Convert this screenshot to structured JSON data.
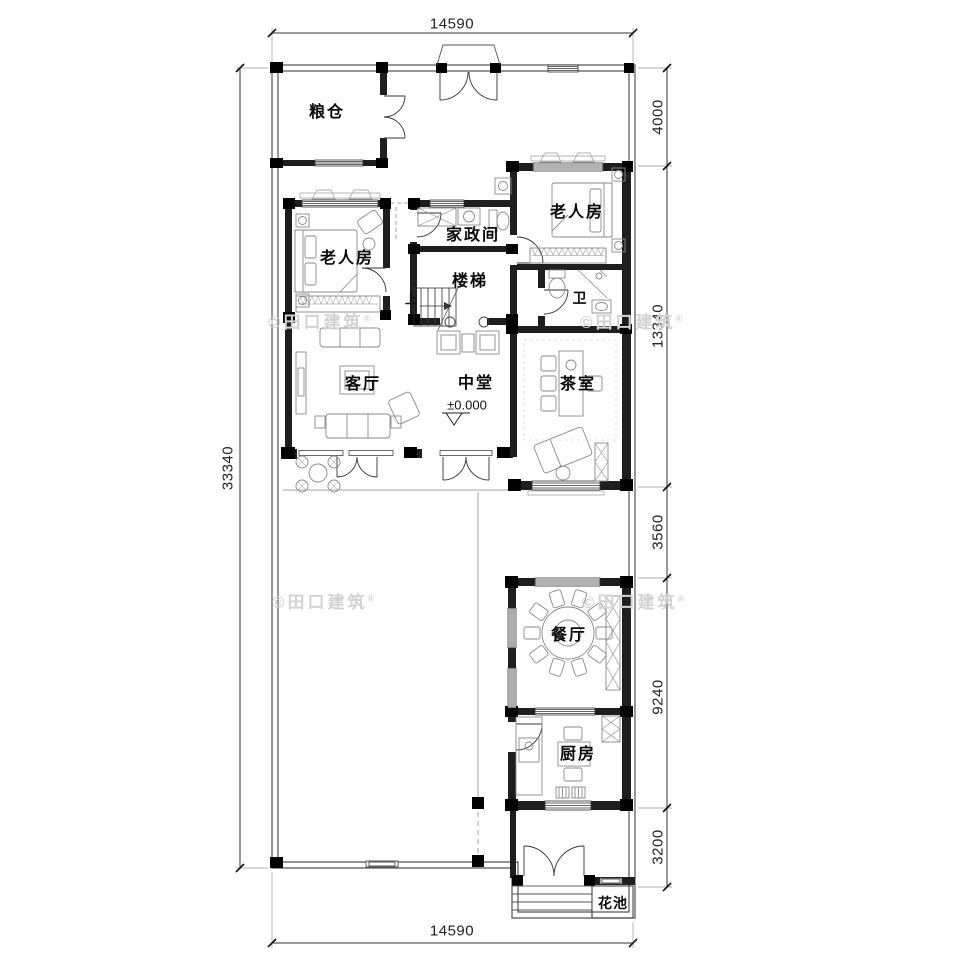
{
  "watermark": {
    "text": "©田口建筑",
    "reg": "®"
  },
  "rooms": {
    "granary": "粮仓",
    "elder_left": "老人房",
    "housekeeping": "家政间",
    "stairs": "楼梯",
    "elder_right": "老人房",
    "bathroom": "卫",
    "living": "客厅",
    "hall": "中堂",
    "tea": "茶室",
    "dining": "餐厅",
    "kitchen": "厨房",
    "flowerbed": "花池"
  },
  "annotations": {
    "level": "±0.000",
    "up": "上"
  },
  "dimensions": {
    "top": "14590",
    "bottom": "14590",
    "left": "33340",
    "right": [
      "4000",
      "13340",
      "3560",
      "9240",
      "3200"
    ]
  }
}
